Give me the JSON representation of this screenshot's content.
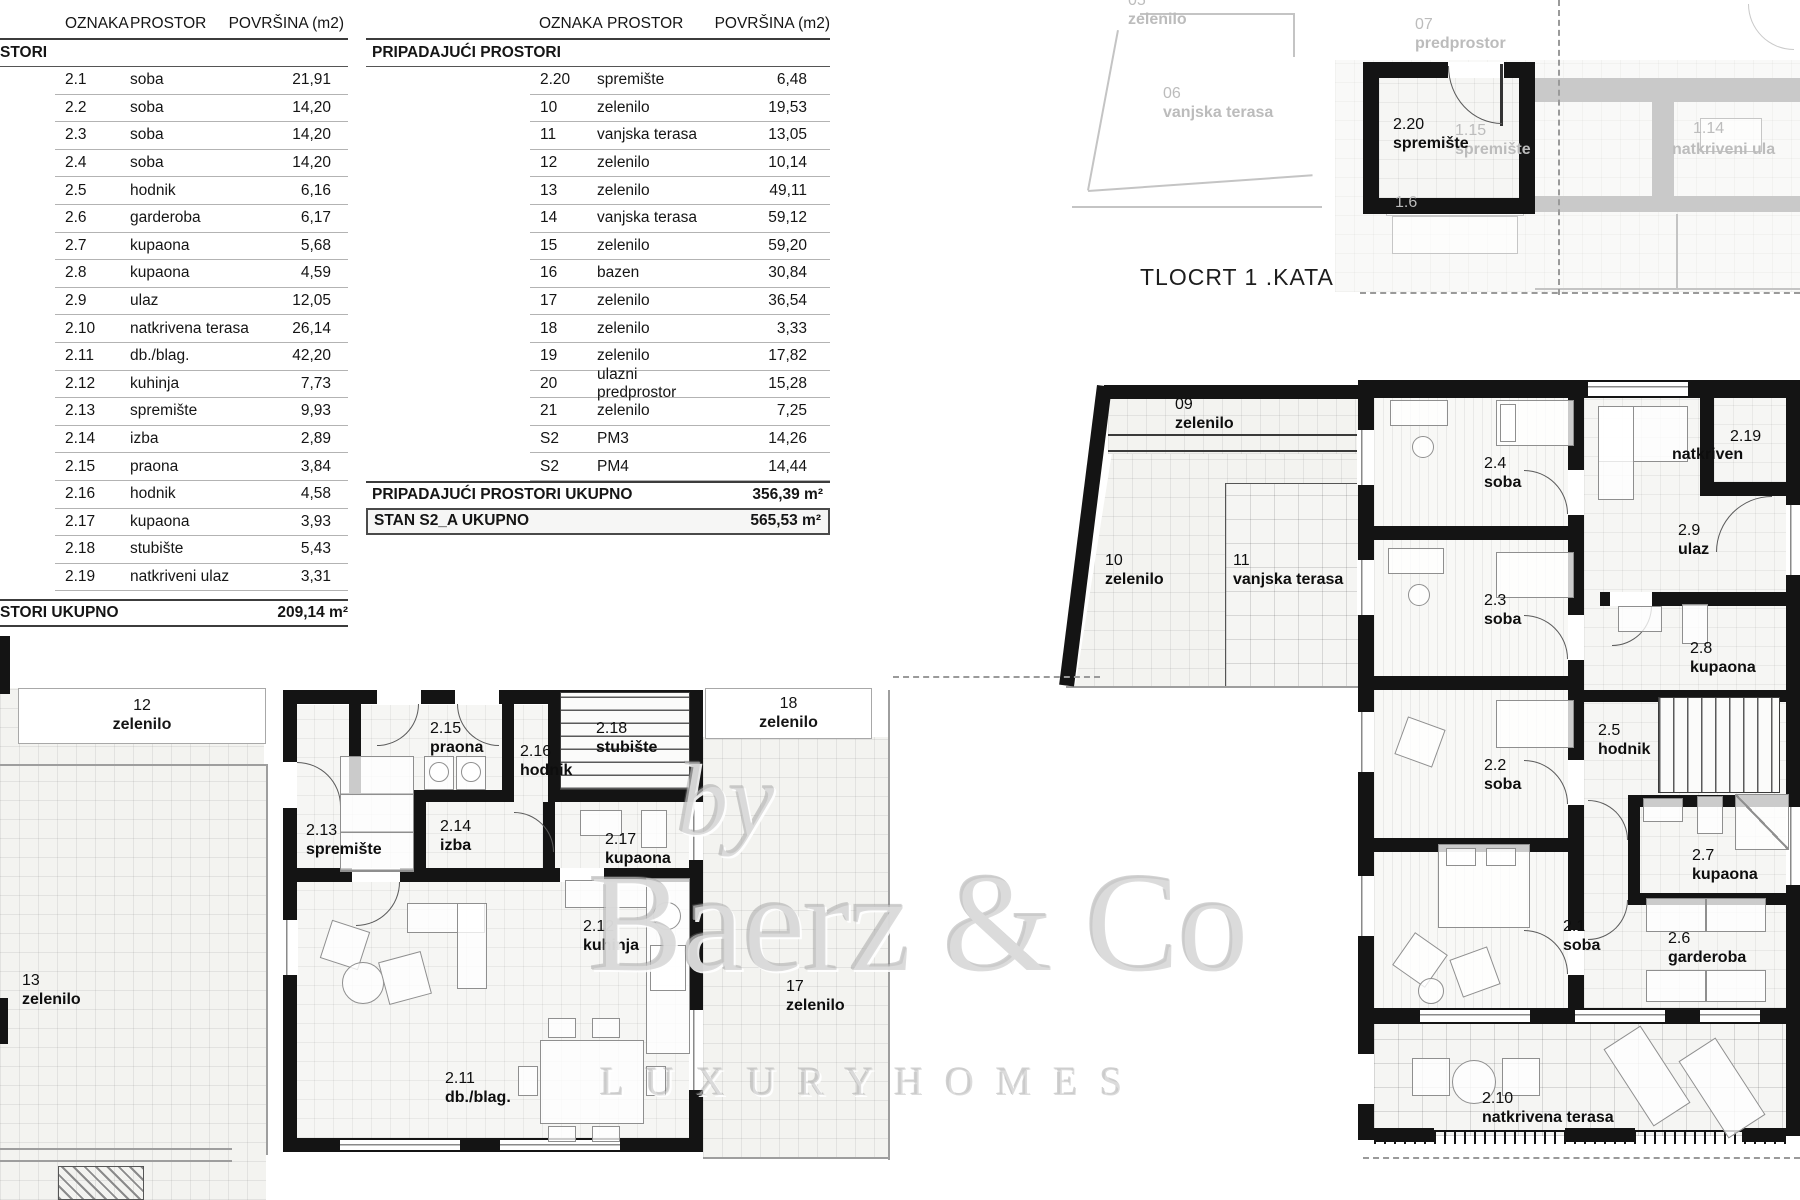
{
  "plan_title": "TLOCRT 1 .KATA",
  "tables": {
    "left": {
      "columns": [
        "OZNAKA",
        "PROSTOR",
        "POVRŠINA (m2)"
      ],
      "section": "STORI",
      "rows": [
        [
          "2.1",
          "soba",
          "21,91"
        ],
        [
          "2.2",
          "soba",
          "14,20"
        ],
        [
          "2.3",
          "soba",
          "14,20"
        ],
        [
          "2.4",
          "soba",
          "14,20"
        ],
        [
          "2.5",
          "hodnik",
          "6,16"
        ],
        [
          "2.6",
          "garderoba",
          "6,17"
        ],
        [
          "2.7",
          "kupaona",
          "5,68"
        ],
        [
          "2.8",
          "kupaona",
          "4,59"
        ],
        [
          "2.9",
          "ulaz",
          "12,05"
        ],
        [
          "2.10",
          "natkrivena terasa",
          "26,14"
        ],
        [
          "2.11",
          "db./blag.",
          "42,20"
        ],
        [
          "2.12",
          "kuhinja",
          "7,73"
        ],
        [
          "2.13",
          "spremište",
          "9,93"
        ],
        [
          "2.14",
          "izba",
          "2,89"
        ],
        [
          "2.15",
          "praona",
          "3,84"
        ],
        [
          "2.16",
          "hodnik",
          "4,58"
        ],
        [
          "2.17",
          "kupaona",
          "3,93"
        ],
        [
          "2.18",
          "stubište",
          "5,43"
        ],
        [
          "2.19",
          "natkriveni ulaz",
          "3,31"
        ]
      ],
      "total_label": "STORI UKUPNO",
      "total_value": "209,14 m²"
    },
    "middle": {
      "columns": [
        "OZNAKA",
        "PROSTOR",
        "POVRŠINA (m2)"
      ],
      "section": "PRIPADAJUĆI PROSTORI",
      "rows": [
        [
          "2.20",
          "spremište",
          "6,48"
        ],
        [
          "10",
          "zelenilo",
          "19,53"
        ],
        [
          "11",
          "vanjska terasa",
          "13,05"
        ],
        [
          "12",
          "zelenilo",
          "10,14"
        ],
        [
          "13",
          "zelenilo",
          "49,11"
        ],
        [
          "14",
          "vanjska terasa",
          "59,12"
        ],
        [
          "15",
          "zelenilo",
          "59,20"
        ],
        [
          "16",
          "bazen",
          "30,84"
        ],
        [
          "17",
          "zelenilo",
          "36,54"
        ],
        [
          "18",
          "zelenilo",
          "3,33"
        ],
        [
          "19",
          "zelenilo",
          "17,82"
        ],
        [
          "20",
          "ulazni predprostor",
          "15,28"
        ],
        [
          "21",
          "zelenilo",
          "7,25"
        ],
        [
          "S2",
          "PM3",
          "14,26"
        ],
        [
          "S2",
          "PM4",
          "14,44"
        ]
      ],
      "total_label": "PRIPADAJUĆI PROSTORI UKUPNO",
      "total_value": "356,39 m²",
      "grand_total_label": "STAN S2_A UKUPNO",
      "grand_total_value": "565,53 m²"
    }
  },
  "watermark": {
    "line1": "by",
    "line2": "Baerz & Co",
    "line3": "L U X U R Y   H O M E S"
  },
  "plans": {
    "ff": {
      "r24": {
        "code": "2.4",
        "name": "soba"
      },
      "r23": {
        "code": "2.3",
        "name": "soba"
      },
      "r22": {
        "code": "2.2",
        "name": "soba"
      },
      "r21": {
        "code": "2.1",
        "name": "soba"
      },
      "r219": {
        "code": "2.19",
        "name": "natkriven"
      },
      "r29": {
        "code": "2.9",
        "name": "ulaz"
      },
      "r28": {
        "code": "2.8",
        "name": "kupaona"
      },
      "r25": {
        "code": "2.5",
        "name": "hodnik"
      },
      "r27": {
        "code": "2.7",
        "name": "kupaona"
      },
      "r26": {
        "code": "2.6",
        "name": "garderoba"
      },
      "r210": {
        "code": "2.10",
        "name": "natkrivena terasa"
      },
      "o09": {
        "code": "09",
        "name": "zelenilo"
      },
      "o10": {
        "code": "10",
        "name": "zelenilo"
      },
      "o11": {
        "code": "11",
        "name": "vanjska terasa"
      }
    },
    "gf": {
      "r215": {
        "code": "2.15",
        "name": "praona"
      },
      "r216": {
        "code": "2.16",
        "name": "hodnik"
      },
      "r218": {
        "code": "2.18",
        "name": "stubište"
      },
      "r213": {
        "code": "2.13",
        "name": "spremište"
      },
      "r214": {
        "code": "2.14",
        "name": "izba"
      },
      "r217": {
        "code": "2.17",
        "name": "kupaona"
      },
      "r212": {
        "code": "2.12",
        "name": "kuhinja"
      },
      "r211": {
        "code": "2.11",
        "name": "db./blag."
      },
      "o12": {
        "code": "12",
        "name": "zelenilo"
      },
      "o13": {
        "code": "13",
        "name": "zelenilo"
      },
      "o17": {
        "code": "17",
        "name": "zelenilo"
      },
      "o18": {
        "code": "18",
        "name": "zelenilo"
      }
    },
    "gray": {
      "r220": {
        "code": "2.20",
        "name": "spremište"
      },
      "o05": {
        "code": "05",
        "name": "zelenilo"
      },
      "o06": {
        "code": "06",
        "name": "vanjska terasa"
      },
      "o07": {
        "code": "07",
        "name": "predprostor"
      },
      "r115": {
        "code": "1.15",
        "name": "spremište"
      },
      "r114": {
        "code": "1.14",
        "name": "natkriveni ula"
      },
      "r16": {
        "code": "1.6",
        "name": ""
      }
    }
  }
}
